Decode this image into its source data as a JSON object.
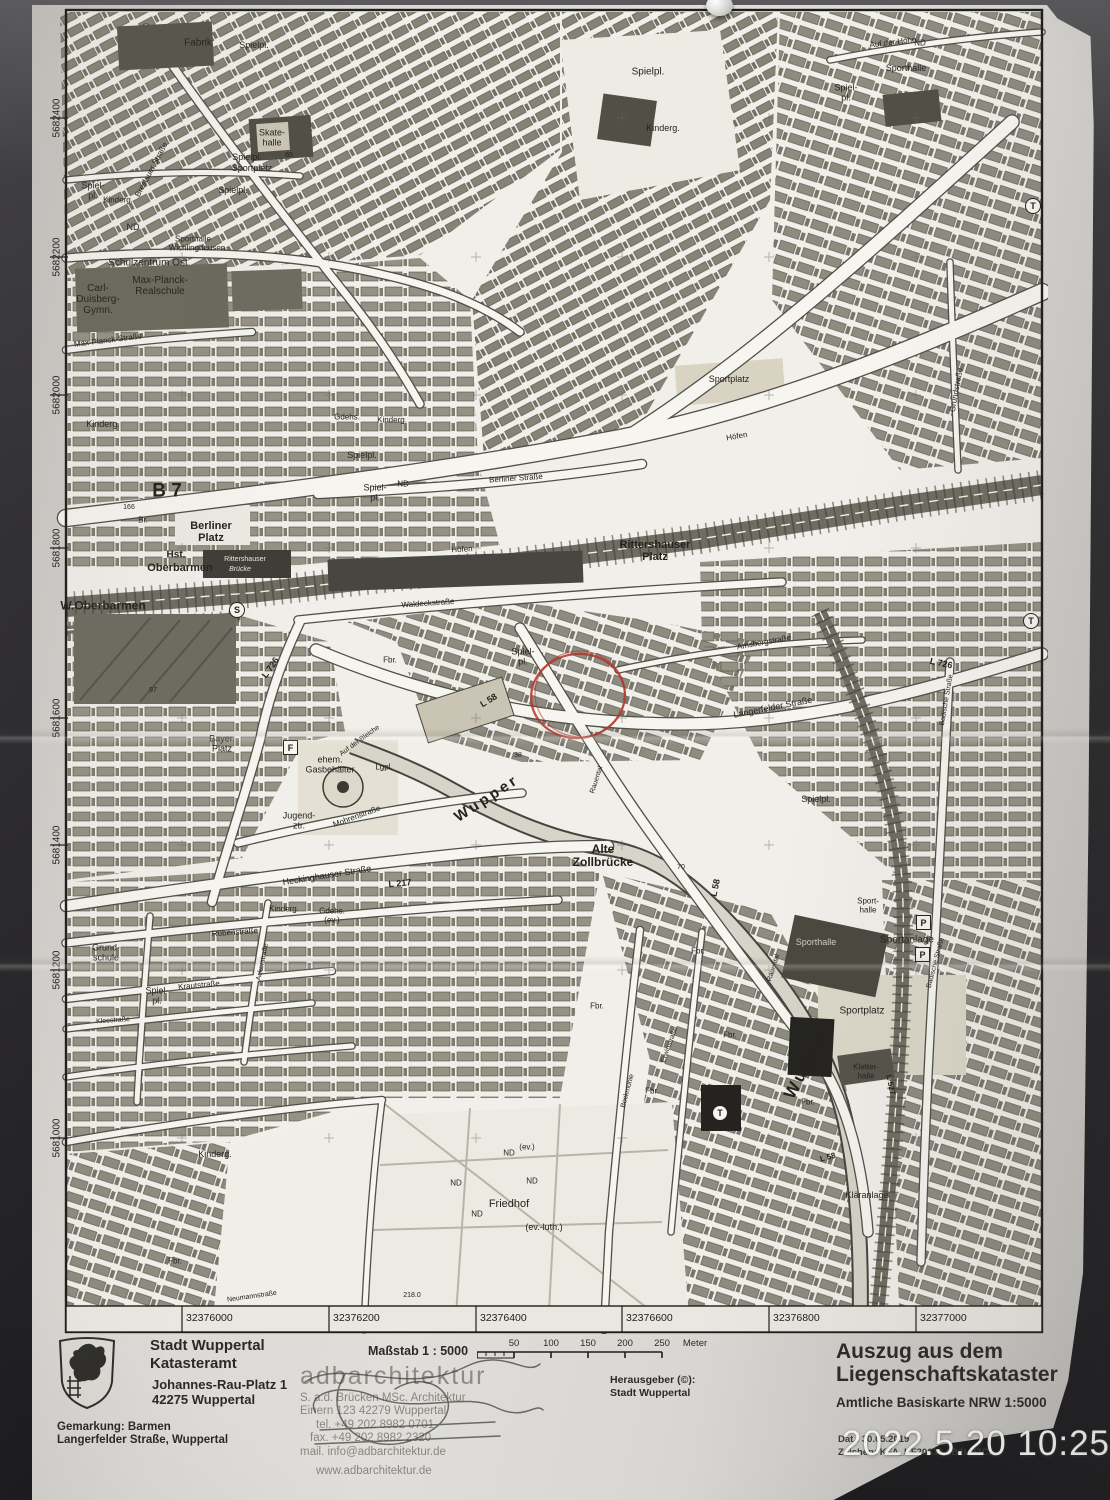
{
  "photo": {
    "timestamp": "2022.5.20 10:25"
  },
  "map": {
    "grid": {
      "left_labels": [
        {
          "t": "5682400",
          "y": 118
        },
        {
          "t": "5682200",
          "y": 257
        },
        {
          "t": "5682000",
          "y": 395
        },
        {
          "t": "5681800",
          "y": 548
        },
        {
          "t": "5681600",
          "y": 718
        },
        {
          "t": "5681400",
          "y": 845
        },
        {
          "t": "5681200",
          "y": 970
        },
        {
          "t": "5681000",
          "y": 1138
        }
      ],
      "bottom_labels": [
        {
          "t": "32376000",
          "x": 182
        },
        {
          "t": "32376200",
          "x": 329
        },
        {
          "t": "32376400",
          "x": 476
        },
        {
          "t": "32376600",
          "x": 622
        },
        {
          "t": "32376800",
          "x": 769
        },
        {
          "t": "32377000",
          "x": 916
        }
      ]
    },
    "annotation_color": "#b5352c",
    "labels": [
      {
        "t": "Fabrik",
        "x": 198,
        "y": 44,
        "s": 10
      },
      {
        "t": "Spielpl.",
        "x": 254,
        "y": 46,
        "s": 9
      },
      {
        "t": "Breslauer Straße",
        "x": 152,
        "y": 170,
        "r": -62,
        "s": 8
      },
      {
        "t": "Skate-\nhalle",
        "x": 272,
        "y": 138,
        "s": 9
      },
      {
        "t": "65",
        "x": 289,
        "y": 156,
        "s": 7
      },
      {
        "t": "Spielpl.",
        "x": 247,
        "y": 158,
        "s": 9
      },
      {
        "t": "Sportplatz",
        "x": 252,
        "y": 169,
        "s": 9
      },
      {
        "t": "Spielpl.",
        "x": 233,
        "y": 191,
        "s": 9
      },
      {
        "t": "Spiel-\npl.",
        "x": 93,
        "y": 191,
        "s": 9
      },
      {
        "t": "Kinderg.",
        "x": 118,
        "y": 201,
        "s": 8
      },
      {
        "t": "ND",
        "x": 133,
        "y": 228,
        "s": 9
      },
      {
        "t": "Sporthalle",
        "x": 193,
        "y": 240,
        "s": 8
      },
      {
        "t": "Wichlinghausen",
        "x": 197,
        "y": 249,
        "s": 8
      },
      {
        "t": "Schulzentrum Ost",
        "x": 148,
        "y": 264,
        "s": 10
      },
      {
        "t": "Carl-\nDuisberg-\nGymn.",
        "x": 98,
        "y": 300,
        "s": 10
      },
      {
        "t": "Max-Planck-\nRealschule",
        "x": 160,
        "y": 287,
        "s": 10
      },
      {
        "t": "Max-Planck-Straße",
        "x": 108,
        "y": 341,
        "r": -7,
        "s": 8
      },
      {
        "t": "Kinderg.",
        "x": 103,
        "y": 425,
        "s": 9
      },
      {
        "t": "Spielpl.",
        "x": 648,
        "y": 73,
        "s": 10
      },
      {
        "t": "Kinderg.",
        "x": 663,
        "y": 129,
        "s": 9
      },
      {
        "t": "Auf der Höhe",
        "x": 893,
        "y": 43,
        "r": -7,
        "s": 8
      },
      {
        "t": "Sporthalle",
        "x": 906,
        "y": 69,
        "s": 9
      },
      {
        "t": "ND",
        "x": 920,
        "y": 44,
        "s": 8
      },
      {
        "t": "Spiel-\npl.",
        "x": 846,
        "y": 93,
        "s": 9
      },
      {
        "t": "T",
        "x": 1032,
        "y": 205,
        "sym": "circle",
        "n": "transformer-symbol"
      },
      {
        "t": "Grundstraße",
        "x": 957,
        "y": 390,
        "r": -80,
        "s": 8
      },
      {
        "t": "Sportplatz",
        "x": 729,
        "y": 380,
        "s": 9
      },
      {
        "t": "Gdehs.",
        "x": 347,
        "y": 418,
        "s": 8
      },
      {
        "t": "Kinderg.",
        "x": 392,
        "y": 421,
        "s": 8
      },
      {
        "t": "Spielpl.",
        "x": 362,
        "y": 456,
        "s": 9
      },
      {
        "t": "Spiel-\npl.",
        "x": 375,
        "y": 493,
        "s": 9
      },
      {
        "t": "ND",
        "x": 403,
        "y": 485,
        "s": 8
      },
      {
        "t": "Berliner Straße",
        "x": 516,
        "y": 479,
        "r": -4,
        "s": 8
      },
      {
        "t": "B 7",
        "x": 167,
        "y": 492,
        "s": 19,
        "w": 600
      },
      {
        "t": "166",
        "x": 129,
        "y": 508,
        "s": 7
      },
      {
        "t": "Br.",
        "x": 143,
        "y": 521,
        "s": 8
      },
      {
        "t": "Berliner\nPlatz",
        "x": 211,
        "y": 533,
        "s": 11,
        "w": 700
      },
      {
        "t": "Rittershauser\nPlatz",
        "x": 655,
        "y": 552,
        "s": 11,
        "w": 700
      },
      {
        "t": "Hst.",
        "x": 176,
        "y": 556,
        "s": 10,
        "w": 700
      },
      {
        "t": "Oberbarmen",
        "x": 180,
        "y": 569,
        "s": 11,
        "w": 700
      },
      {
        "t": "Rittershauser",
        "x": 245,
        "y": 560,
        "s": 7,
        "c": "#e8e6df"
      },
      {
        "t": "Brücke",
        "x": 240,
        "y": 570,
        "s": 7,
        "i": 1,
        "c": "#e8e6df"
      },
      {
        "t": "W.Oberbarmen",
        "x": 103,
        "y": 606,
        "s": 12,
        "w": 700
      },
      {
        "t": "S",
        "x": 236,
        "y": 609,
        "sym": "circle",
        "n": "sbahn-station-symbol"
      },
      {
        "t": "Höfen",
        "x": 462,
        "y": 550,
        "r": -3,
        "s": 8
      },
      {
        "t": "Höfen",
        "x": 737,
        "y": 437,
        "r": -10,
        "s": 8
      },
      {
        "t": "Waldeckstraße",
        "x": 428,
        "y": 604,
        "r": -4,
        "s": 8
      },
      {
        "t": "L 726",
        "x": 271,
        "y": 668,
        "r": -55,
        "s": 9,
        "w": 600
      },
      {
        "t": "Fbr.",
        "x": 390,
        "y": 661,
        "s": 8
      },
      {
        "t": "Spiel-\npl.",
        "x": 523,
        "y": 657,
        "s": 9
      },
      {
        "t": "L 58",
        "x": 489,
        "y": 701,
        "r": -32,
        "s": 9,
        "w": 600
      },
      {
        "t": "Amsbergstraße",
        "x": 764,
        "y": 643,
        "r": -10,
        "s": 8
      },
      {
        "t": "Langerfelder Straße",
        "x": 773,
        "y": 708,
        "r": -11,
        "s": 9
      },
      {
        "t": "L 726",
        "x": 941,
        "y": 664,
        "r": 12,
        "s": 9,
        "w": 600
      },
      {
        "t": "Badische Straße",
        "x": 947,
        "y": 700,
        "r": -80,
        "s": 7
      },
      {
        "t": "T",
        "x": 1030,
        "y": 620,
        "sym": "circle",
        "n": "transformer-symbol"
      },
      {
        "t": "97",
        "x": 153,
        "y": 691,
        "s": 7
      },
      {
        "t": "Bayer.\nPlatz",
        "x": 222,
        "y": 744,
        "s": 9
      },
      {
        "t": "F",
        "x": 290,
        "y": 747,
        "sym": "box",
        "n": "f-symbol"
      },
      {
        "t": "ehem.\nGasbehälter",
        "x": 330,
        "y": 765,
        "s": 9
      },
      {
        "t": "Lgpl.",
        "x": 384,
        "y": 768,
        "s": 8
      },
      {
        "t": "38",
        "x": 518,
        "y": 756,
        "s": 7
      },
      {
        "t": "Wupper",
        "x": 487,
        "y": 799,
        "r": -33,
        "s": 15,
        "w": 700,
        "sp": 3,
        "n": "river-label"
      },
      {
        "t": "Rauental",
        "x": 597,
        "y": 780,
        "r": -72,
        "s": 7
      },
      {
        "t": "Jugend-\nztr.",
        "x": 299,
        "y": 821,
        "s": 9
      },
      {
        "t": "Mohrenstraße",
        "x": 357,
        "y": 817,
        "r": -20,
        "s": 8
      },
      {
        "t": "Auf der Bleiche",
        "x": 360,
        "y": 741,
        "r": -36,
        "s": 7
      },
      {
        "t": "Alte\nZollbrücke",
        "x": 603,
        "y": 856,
        "s": 12,
        "w": 700
      },
      {
        "t": "70",
        "x": 681,
        "y": 868,
        "s": 7
      },
      {
        "t": "Spielpl.",
        "x": 816,
        "y": 800,
        "s": 9
      },
      {
        "t": "L 58",
        "x": 716,
        "y": 888,
        "r": -78,
        "s": 9,
        "w": 600
      },
      {
        "t": "Heckinghauser Straße",
        "x": 327,
        "y": 876,
        "r": -9,
        "s": 9
      },
      {
        "t": "L 217",
        "x": 400,
        "y": 884,
        "r": -5,
        "s": 9,
        "w": 600
      },
      {
        "t": "Wupper",
        "x": 808,
        "y": 1062,
        "r": -62,
        "s": 17,
        "w": 700,
        "sp": 3,
        "n": "river-label"
      },
      {
        "t": "Kinderg.",
        "x": 284,
        "y": 910,
        "s": 8
      },
      {
        "t": "Gdehs.\n(ev.)",
        "x": 332,
        "y": 916,
        "s": 8
      },
      {
        "t": "Rübenstraße",
        "x": 235,
        "y": 933,
        "r": -4,
        "s": 8
      },
      {
        "t": "Ackerstraße",
        "x": 263,
        "y": 962,
        "r": -78,
        "s": 7
      },
      {
        "t": "Grund-\nschule",
        "x": 106,
        "y": 953,
        "s": 9
      },
      {
        "t": "Krautstraße",
        "x": 199,
        "y": 986,
        "r": -5,
        "s": 8
      },
      {
        "t": "Spiel-\npl.",
        "x": 157,
        "y": 996,
        "s": 9
      },
      {
        "t": "Kleestraße",
        "x": 113,
        "y": 1021,
        "r": -4,
        "s": 7
      },
      {
        "t": "Kinderg.",
        "x": 215,
        "y": 1155,
        "s": 9
      },
      {
        "t": "Fbr.",
        "x": 175,
        "y": 1262,
        "s": 8
      },
      {
        "t": "Neumannstraße",
        "x": 252,
        "y": 1297,
        "r": -8,
        "s": 7
      },
      {
        "t": "218.0",
        "x": 412,
        "y": 1296,
        "s": 7
      },
      {
        "t": "ND",
        "x": 456,
        "y": 1184,
        "s": 8
      },
      {
        "t": "ND",
        "x": 509,
        "y": 1154,
        "s": 8
      },
      {
        "t": "(ev.)",
        "x": 527,
        "y": 1148,
        "s": 8
      },
      {
        "t": "ND",
        "x": 532,
        "y": 1182,
        "s": 8
      },
      {
        "t": "ND",
        "x": 477,
        "y": 1215,
        "s": 8
      },
      {
        "t": "Friedhof",
        "x": 509,
        "y": 1205,
        "s": 11
      },
      {
        "t": "(ev.-luth.)",
        "x": 544,
        "y": 1228,
        "s": 9
      },
      {
        "t": "Fbr.",
        "x": 597,
        "y": 1007,
        "s": 8
      },
      {
        "t": "Fbr.",
        "x": 698,
        "y": 952,
        "s": 8
      },
      {
        "t": "Fbr.",
        "x": 730,
        "y": 1036,
        "s": 8
      },
      {
        "t": "Fbr.",
        "x": 652,
        "y": 1092,
        "s": 8
      },
      {
        "t": "Erwinstraße",
        "x": 670,
        "y": 1045,
        "r": -70,
        "s": 7
      },
      {
        "t": "Bockmühle",
        "x": 628,
        "y": 1091,
        "r": -75,
        "s": 7
      },
      {
        "t": "T",
        "x": 719,
        "y": 1112,
        "sym": "circle",
        "n": "transformer-symbol"
      },
      {
        "t": "Sporthalle",
        "x": 816,
        "y": 943,
        "s": 9,
        "c": "#cfccc2"
      },
      {
        "t": "Sport-\nhalle",
        "x": 868,
        "y": 906,
        "s": 8
      },
      {
        "t": "Sportanlage",
        "x": 907,
        "y": 941,
        "s": 10
      },
      {
        "t": "P",
        "x": 923,
        "y": 922,
        "sym": "box",
        "n": "parking-symbol"
      },
      {
        "t": "P",
        "x": 922,
        "y": 954,
        "sym": "box",
        "n": "parking-symbol"
      },
      {
        "t": "Sportplatz",
        "x": 862,
        "y": 1012,
        "s": 10
      },
      {
        "t": "Rauental",
        "x": 774,
        "y": 968,
        "r": -72,
        "s": 7
      },
      {
        "t": "Badische Straße",
        "x": 936,
        "y": 963,
        "r": -75,
        "s": 7
      },
      {
        "t": "Kletter-\nhalle",
        "x": 866,
        "y": 1072,
        "s": 8
      },
      {
        "t": "Fbr.",
        "x": 808,
        "y": 1103,
        "s": 8
      },
      {
        "t": "L 527",
        "x": 890,
        "y": 1085,
        "r": 78,
        "s": 8,
        "w": 600
      },
      {
        "t": "Kläranlage",
        "x": 867,
        "y": 1196,
        "s": 9
      },
      {
        "t": "L 58",
        "x": 828,
        "y": 1158,
        "r": -15,
        "s": 8,
        "w": 600
      }
    ]
  },
  "footer": {
    "issuer": {
      "title1": "Stadt Wuppertal",
      "title2": "Katasteramt",
      "address1": "Johannes-Rau-Platz 1",
      "address2": "42275 Wuppertal",
      "gemarkung": "Gemarkung: Barmen",
      "location": "Langerfelder Straße, Wuppertal"
    },
    "scale": {
      "label": "Maßstab 1 : 5000",
      "ticks": [
        "50",
        "100",
        "150",
        "200",
        "250"
      ],
      "unit": "Meter"
    },
    "architect": {
      "name": "adbarchitektur",
      "line1": "S. a.d. Brücken MSc. Architektur",
      "line2": "Einern 123 42279 Wuppertal",
      "line3": "tel. +49 202 8982 0701",
      "line4": "fax. +49 202 8982 2320",
      "line5": "mail. info@adbarchitektur.de",
      "web": "www.adbarchitektur.de"
    },
    "publisher": {
      "label": "Herausgeber (©):",
      "name": "Stadt Wuppertal"
    },
    "extract": {
      "title1": "Auszug aus dem",
      "title2": "Liegenschaftskataster",
      "subtitle": "Amtliche Basiskarte NRW 1:5000",
      "date_line": "Dat.: 30.05.2019",
      "ref_line": "Zeichen: KFA_KF20630-6B2LN3Ct"
    }
  }
}
